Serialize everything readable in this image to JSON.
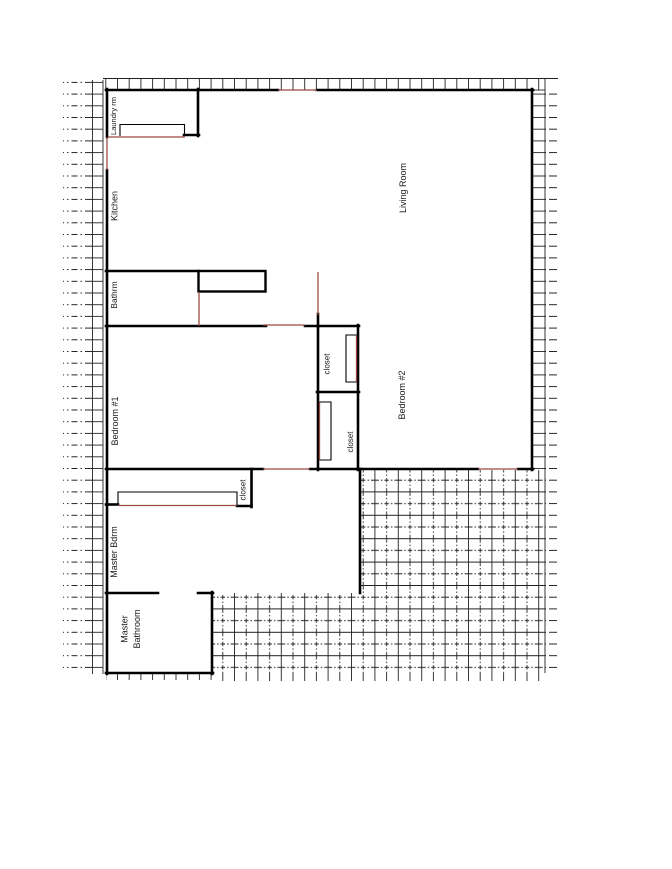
{
  "rooms": {
    "laundry_rm": "Laundry rm",
    "kitchen": "Kitchen",
    "living_room": "Living Room",
    "bathrm": "Bathrm",
    "bedroom_1": "Bedroom #1",
    "bedroom_2": "Bedroom #2",
    "closet_bedroom2_upper": "closet",
    "closet_bedroom2_lower": "closet",
    "closet_master": "closet",
    "master_bdrm": "Master Bdrm",
    "master_bathroom_line1": "Master",
    "master_bathroom_line2": "Bathroom"
  },
  "colors": {
    "wall": "#000000",
    "opening": "#9a4a44",
    "hatch": "#222222"
  }
}
